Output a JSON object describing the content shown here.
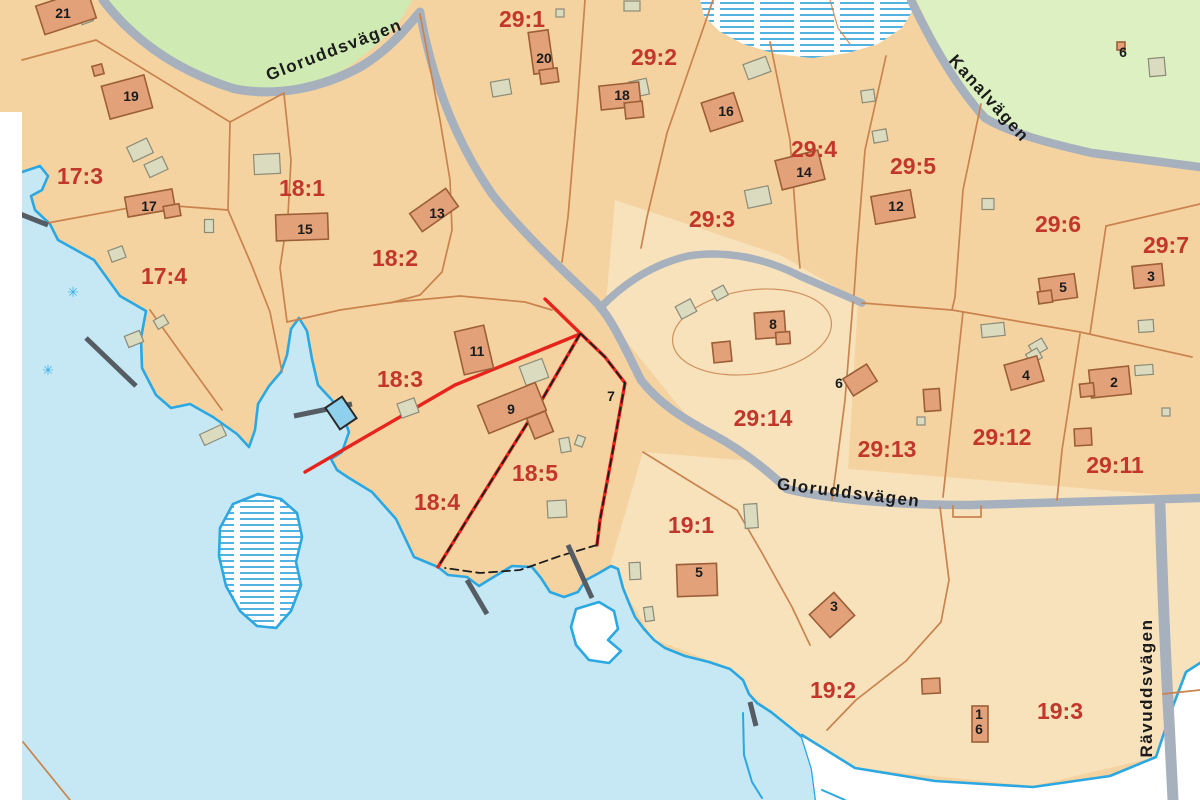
{
  "map_title": "Cadastral parcel map",
  "colors": {
    "land": "#f5d3a0",
    "land_light": "#f8e2bc",
    "water": "#c6e8f4",
    "water_line": "#2ba7e1",
    "green": "#cfeab2",
    "green2": "#dcf0c1",
    "road": "#a7b1be",
    "boundary": "#c9834e",
    "highlight": "#e8231c",
    "dash": "#1d1d1d",
    "jetty": "#565c63",
    "house_fill": "#e2a178",
    "house_stroke": "#9c5f38",
    "shed_fill": "#dbdbc0",
    "shed_stroke": "#8b8b78",
    "parcel_label": "#c2372c",
    "text": "#1c1c1c",
    "pool_fill": "#8fd0ec",
    "pool_stroke": "#2a2a2a",
    "reed": "#3ab0e8"
  },
  "parcel_labels": [
    {
      "text": "17:3",
      "x": 80,
      "y": 184
    },
    {
      "text": "17:4",
      "x": 164,
      "y": 284
    },
    {
      "text": "18:1",
      "x": 302,
      "y": 196
    },
    {
      "text": "18:2",
      "x": 395,
      "y": 266
    },
    {
      "text": "18:3",
      "x": 400,
      "y": 387
    },
    {
      "text": "18:4",
      "x": 437,
      "y": 510
    },
    {
      "text": "18:5",
      "x": 535,
      "y": 481
    },
    {
      "text": "29:1",
      "x": 522,
      "y": 27
    },
    {
      "text": "29:2",
      "x": 654,
      "y": 65
    },
    {
      "text": "29:3",
      "x": 712,
      "y": 227
    },
    {
      "text": "29:4",
      "x": 814,
      "y": 157
    },
    {
      "text": "29:5",
      "x": 913,
      "y": 174
    },
    {
      "text": "29:6",
      "x": 1058,
      "y": 232
    },
    {
      "text": "29:7",
      "x": 1166,
      "y": 253
    },
    {
      "text": "29:14",
      "x": 763,
      "y": 426
    },
    {
      "text": "29:13",
      "x": 887,
      "y": 457
    },
    {
      "text": "29:12",
      "x": 1002,
      "y": 445
    },
    {
      "text": "29:11",
      "x": 1115,
      "y": 473
    },
    {
      "text": "19:1",
      "x": 691,
      "y": 533
    },
    {
      "text": "19:2",
      "x": 833,
      "y": 698
    },
    {
      "text": "19:3",
      "x": 1060,
      "y": 719
    }
  ],
  "house_numbers": [
    {
      "text": "21",
      "x": 63,
      "y": 18
    },
    {
      "text": "19",
      "x": 131,
      "y": 101
    },
    {
      "text": "17",
      "x": 149,
      "y": 211
    },
    {
      "text": "15",
      "x": 305,
      "y": 234
    },
    {
      "text": "13",
      "x": 437,
      "y": 218
    },
    {
      "text": "11",
      "x": 477,
      "y": 356
    },
    {
      "text": "9",
      "x": 511,
      "y": 414
    },
    {
      "text": "7",
      "x": 611,
      "y": 401
    },
    {
      "text": "20",
      "x": 544,
      "y": 63
    },
    {
      "text": "18",
      "x": 622,
      "y": 100
    },
    {
      "text": "16",
      "x": 726,
      "y": 116
    },
    {
      "text": "14",
      "x": 804,
      "y": 177
    },
    {
      "text": "12",
      "x": 896,
      "y": 211
    },
    {
      "text": "8",
      "x": 773,
      "y": 329
    },
    {
      "text": "6",
      "x": 839,
      "y": 388
    },
    {
      "text": "5",
      "x": 1063,
      "y": 292
    },
    {
      "text": "3",
      "x": 1151,
      "y": 281
    },
    {
      "text": "4",
      "x": 1026,
      "y": 380
    },
    {
      "text": "2",
      "x": 1114,
      "y": 387
    },
    {
      "text": "6",
      "x": 1123,
      "y": 57
    },
    {
      "text": "5",
      "x": 699,
      "y": 577
    },
    {
      "text": "3",
      "x": 834,
      "y": 611
    },
    {
      "text": "1",
      "x": 979,
      "y": 719
    },
    {
      "text": "6",
      "x": 979,
      "y": 734
    }
  ],
  "road_labels": [
    {
      "text": "Gloruddsvägen",
      "x": 336,
      "y": 55,
      "rot": -21
    },
    {
      "text": "Gloruddsvägen",
      "x": 848,
      "y": 498,
      "rot": 7
    },
    {
      "text": "Kanalvägen",
      "x": 985,
      "y": 102,
      "rot": 48
    },
    {
      "text": "Rävuddsvägen",
      "x": 1152,
      "y": 688,
      "rot": -90
    }
  ],
  "buildings": [
    {
      "x": 66,
      "y": 12,
      "w": 54,
      "h": 30,
      "r": -18
    },
    {
      "x": 98,
      "y": 70,
      "w": 10,
      "h": 10,
      "r": -15
    },
    {
      "x": 127,
      "y": 97,
      "w": 44,
      "h": 34,
      "r": -15
    },
    {
      "x": 150,
      "y": 203,
      "w": 48,
      "h": 20,
      "r": -10
    },
    {
      "x": 172,
      "y": 211,
      "w": 16,
      "h": 12,
      "r": -10
    },
    {
      "x": 302,
      "y": 227,
      "w": 52,
      "h": 26,
      "r": -2
    },
    {
      "x": 434,
      "y": 210,
      "w": 44,
      "h": 22,
      "r": -35
    },
    {
      "x": 474,
      "y": 350,
      "w": 30,
      "h": 44,
      "r": -13
    },
    {
      "x": 512,
      "y": 408,
      "w": 62,
      "h": 30,
      "r": -22
    },
    {
      "x": 540,
      "y": 425,
      "w": 20,
      "h": 22,
      "r": -22
    },
    {
      "x": 541,
      "y": 52,
      "w": 20,
      "h": 42,
      "r": -8
    },
    {
      "x": 549,
      "y": 76,
      "w": 18,
      "h": 14,
      "r": -8
    },
    {
      "x": 620,
      "y": 96,
      "w": 40,
      "h": 24,
      "r": -6
    },
    {
      "x": 634,
      "y": 110,
      "w": 18,
      "h": 16,
      "r": -6
    },
    {
      "x": 722,
      "y": 112,
      "w": 34,
      "h": 30,
      "r": -18
    },
    {
      "x": 800,
      "y": 170,
      "w": 44,
      "h": 30,
      "r": -14
    },
    {
      "x": 893,
      "y": 207,
      "w": 40,
      "h": 28,
      "r": -10
    },
    {
      "x": 770,
      "y": 325,
      "w": 30,
      "h": 26,
      "r": -4
    },
    {
      "x": 783,
      "y": 338,
      "w": 14,
      "h": 12,
      "r": -4
    },
    {
      "x": 722,
      "y": 352,
      "w": 18,
      "h": 20,
      "r": -6
    },
    {
      "x": 860,
      "y": 380,
      "w": 28,
      "h": 20,
      "r": -32
    },
    {
      "x": 932,
      "y": 400,
      "w": 16,
      "h": 22,
      "r": -4
    },
    {
      "x": 1058,
      "y": 288,
      "w": 36,
      "h": 24,
      "r": -8
    },
    {
      "x": 1045,
      "y": 297,
      "w": 14,
      "h": 12,
      "r": -8
    },
    {
      "x": 1148,
      "y": 276,
      "w": 30,
      "h": 22,
      "r": -6
    },
    {
      "x": 1024,
      "y": 373,
      "w": 34,
      "h": 26,
      "r": -16
    },
    {
      "x": 1110,
      "y": 382,
      "w": 40,
      "h": 28,
      "r": -6
    },
    {
      "x": 1087,
      "y": 390,
      "w": 14,
      "h": 13,
      "r": -6
    },
    {
      "x": 1083,
      "y": 437,
      "w": 17,
      "h": 17,
      "r": -3
    },
    {
      "x": 697,
      "y": 580,
      "w": 40,
      "h": 32,
      "r": -2
    },
    {
      "x": 832,
      "y": 615,
      "w": 33,
      "h": 31,
      "r": -42
    },
    {
      "x": 980,
      "y": 724,
      "w": 16,
      "h": 36,
      "r": 0
    },
    {
      "x": 931,
      "y": 686,
      "w": 18,
      "h": 15,
      "r": -3
    },
    {
      "x": 1121,
      "y": 46,
      "w": 8,
      "h": 8,
      "r": 0
    }
  ],
  "sheds": [
    {
      "x": 86,
      "y": 18,
      "w": 12,
      "h": 10,
      "r": -20
    },
    {
      "x": 140,
      "y": 150,
      "w": 22,
      "h": 16,
      "r": -25
    },
    {
      "x": 156,
      "y": 167,
      "w": 20,
      "h": 14,
      "r": -25
    },
    {
      "x": 267,
      "y": 164,
      "w": 26,
      "h": 20,
      "r": -3
    },
    {
      "x": 117,
      "y": 254,
      "w": 15,
      "h": 12,
      "r": -20
    },
    {
      "x": 134,
      "y": 339,
      "w": 16,
      "h": 12,
      "r": -22
    },
    {
      "x": 209,
      "y": 226,
      "w": 9,
      "h": 13,
      "r": 0
    },
    {
      "x": 161,
      "y": 322,
      "w": 12,
      "h": 10,
      "r": -30
    },
    {
      "x": 213,
      "y": 435,
      "w": 24,
      "h": 12,
      "r": -25
    },
    {
      "x": 501,
      "y": 88,
      "w": 19,
      "h": 15,
      "r": -10
    },
    {
      "x": 560,
      "y": 13,
      "w": 8,
      "h": 8,
      "r": 0
    },
    {
      "x": 632,
      "y": 6,
      "w": 16,
      "h": 10,
      "r": 0
    },
    {
      "x": 639,
      "y": 88,
      "w": 18,
      "h": 16,
      "r": -12
    },
    {
      "x": 757,
      "y": 68,
      "w": 24,
      "h": 16,
      "r": -20
    },
    {
      "x": 758,
      "y": 197,
      "w": 24,
      "h": 18,
      "r": -12
    },
    {
      "x": 868,
      "y": 96,
      "w": 13,
      "h": 12,
      "r": -8
    },
    {
      "x": 880,
      "y": 136,
      "w": 14,
      "h": 12,
      "r": -10
    },
    {
      "x": 988,
      "y": 204,
      "w": 12,
      "h": 11,
      "r": 0
    },
    {
      "x": 1157,
      "y": 67,
      "w": 16,
      "h": 18,
      "r": -5
    },
    {
      "x": 1146,
      "y": 326,
      "w": 15,
      "h": 12,
      "r": -4
    },
    {
      "x": 993,
      "y": 330,
      "w": 23,
      "h": 13,
      "r": -6
    },
    {
      "x": 1038,
      "y": 347,
      "w": 15,
      "h": 12,
      "r": -30
    },
    {
      "x": 1034,
      "y": 356,
      "w": 13,
      "h": 11,
      "r": -30
    },
    {
      "x": 1144,
      "y": 370,
      "w": 18,
      "h": 10,
      "r": -4
    },
    {
      "x": 1166,
      "y": 412,
      "w": 8,
      "h": 8,
      "r": 0
    },
    {
      "x": 921,
      "y": 421,
      "w": 8,
      "h": 8,
      "r": 0
    },
    {
      "x": 686,
      "y": 309,
      "w": 17,
      "h": 14,
      "r": -28
    },
    {
      "x": 720,
      "y": 293,
      "w": 13,
      "h": 11,
      "r": -28
    },
    {
      "x": 751,
      "y": 516,
      "w": 13,
      "h": 24,
      "r": -4
    },
    {
      "x": 635,
      "y": 571,
      "w": 11,
      "h": 17,
      "r": -3
    },
    {
      "x": 649,
      "y": 614,
      "w": 9,
      "h": 14,
      "r": -8
    },
    {
      "x": 408,
      "y": 408,
      "w": 18,
      "h": 15,
      "r": -20
    },
    {
      "x": 534,
      "y": 372,
      "w": 24,
      "h": 20,
      "r": -20
    },
    {
      "x": 557,
      "y": 509,
      "w": 19,
      "h": 17,
      "r": -3
    },
    {
      "x": 565,
      "y": 445,
      "w": 10,
      "h": 14,
      "r": -10
    },
    {
      "x": 580,
      "y": 441,
      "w": 8,
      "h": 10,
      "r": 20
    }
  ],
  "pool": {
    "x": 341,
    "y": 413,
    "w": 20,
    "h": 26,
    "r": -34
  },
  "reeds": [
    {
      "x": 73,
      "y": 297
    },
    {
      "x": 48,
      "y": 375
    }
  ],
  "reed_glyph": "✳"
}
